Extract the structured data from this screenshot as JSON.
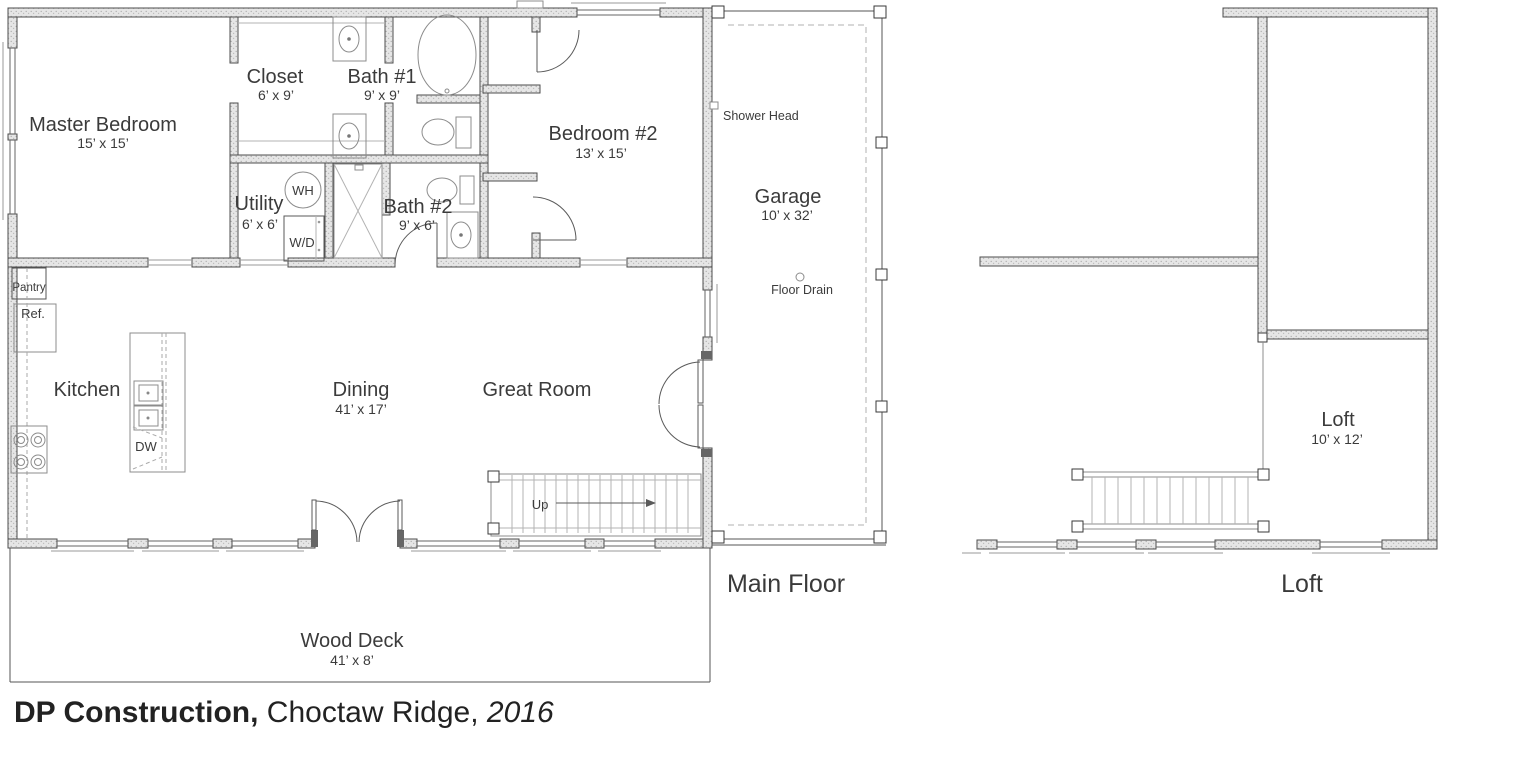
{
  "title_block": {
    "company": "DP Construction,",
    "location": " Choctaw Ridge, ",
    "year": "2016"
  },
  "floor_titles": {
    "main": "Main Floor",
    "loft": "Loft"
  },
  "rooms": {
    "master_bedroom": {
      "name": "Master Bedroom",
      "dims": "15’ x 15’"
    },
    "closet": {
      "name": "Closet",
      "dims": "6’ x 9’"
    },
    "bath_1": {
      "name": "Bath #1",
      "dims": "9’ x 9’"
    },
    "bedroom_2": {
      "name": "Bedroom #2",
      "dims": "13’ x 15’"
    },
    "utility": {
      "name": "Utility",
      "dims": "6’ x 6’"
    },
    "bath_2": {
      "name": "Bath #2",
      "dims": "9’ x 6’"
    },
    "kitchen": {
      "name": "Kitchen"
    },
    "dining": {
      "name": "Dining",
      "dims": "41’ x 17’"
    },
    "great_room": {
      "name": "Great Room"
    },
    "garage": {
      "name": "Garage",
      "dims": "10’ x 32’"
    },
    "wood_deck": {
      "name": "Wood Deck",
      "dims": "41’ x 8’"
    },
    "loft": {
      "name": "Loft",
      "dims": "10’ x 12’"
    }
  },
  "annotations": {
    "pantry": "Pantry",
    "refrigerator": "Ref.",
    "water_heater": "WH",
    "washer_dryer": "W/D",
    "dishwasher": "DW",
    "stairs_up": "Up",
    "shower_head": "Shower Head",
    "floor_drain": "Floor Drain"
  },
  "colors": {
    "wall_stroke": "#4d4d4d",
    "wall_fill": "#e3e3e3",
    "fixture_line": "#8c8c8c",
    "label_text": "#3b3b3b",
    "caption_text": "#222222",
    "background": "#ffffff"
  }
}
